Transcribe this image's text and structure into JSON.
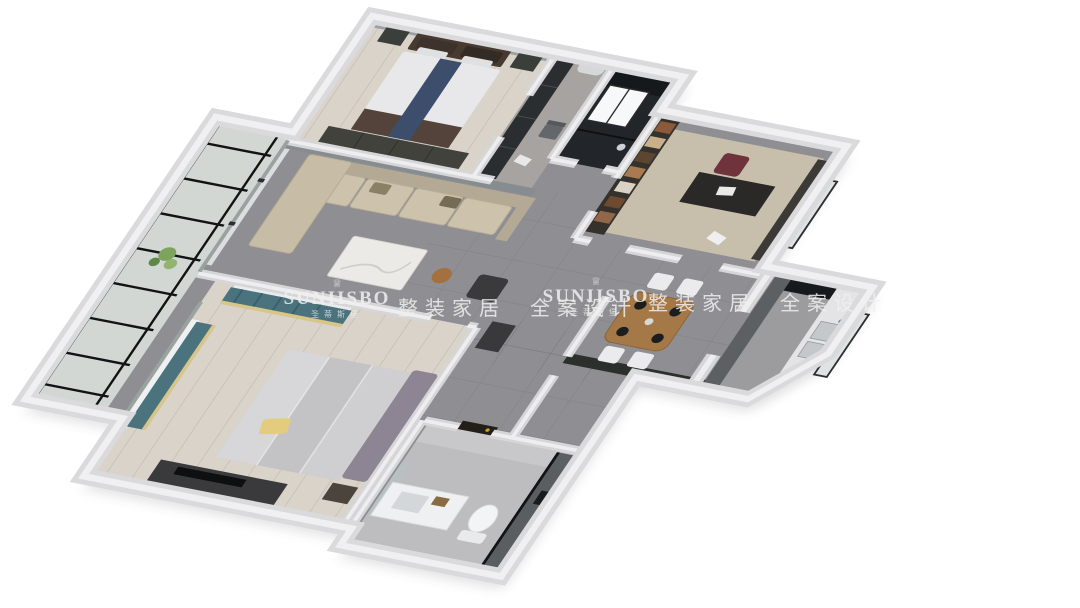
{
  "watermark": {
    "brand": "SUNIISBO",
    "brand_sub": "圣蒂斯堡",
    "slogan": "整装家居 全案设计",
    "crown_icon": "♕",
    "color": "#f0f0f0"
  },
  "scene": {
    "type": "3d-rendered-floor-plan",
    "view": "axonometric-top-down",
    "background": "#ffffff",
    "rooms": [
      {
        "id": "bedroom-top",
        "floor": "#d9d3c9",
        "features": [
          "double-bed",
          "dark-wardrobe",
          "gray-panel-headboard-wall",
          "blue-bed-runner"
        ]
      },
      {
        "id": "dressing-room",
        "floor": "#a6a3a0",
        "features": [
          "dark-wardrobe",
          "arched-mirror",
          "chair"
        ]
      },
      {
        "id": "bathroom-dark",
        "floor": "#22262a",
        "features": [
          "black-tile-walls",
          "white-window",
          "glass-partition"
        ]
      },
      {
        "id": "study",
        "floor": "#c8beac",
        "features": [
          "bookshelf",
          "desk",
          "maroon-chair",
          "window"
        ]
      },
      {
        "id": "living-room",
        "floor": "#8f8f93",
        "features": [
          "l-shaped-beige-sofa",
          "marble-coffee-table",
          "balcony-glass-doors"
        ]
      },
      {
        "id": "dining-room",
        "floor": "#8f8f93",
        "features": [
          "wood-table",
          "four-white-chairs",
          "black-plates",
          "dark-panel-wall"
        ]
      },
      {
        "id": "kitchen",
        "floor": "#9c9c9e",
        "features": [
          "white-counter",
          "double-sink",
          "black-range-hood",
          "window"
        ]
      },
      {
        "id": "master-bedroom",
        "floor": "#d9d3c9",
        "features": [
          "gray-bed",
          "mauve-headboard",
          "teal-curtains",
          "yellow-pillow",
          "tv-dresser"
        ]
      },
      {
        "id": "bathroom-main",
        "floor": "#bdbdbf",
        "features": [
          "vanity",
          "toilet",
          "dark-glass-shower"
        ]
      },
      {
        "id": "balcony",
        "floor": "#ccd2cf",
        "features": [
          "black-grid-glazing",
          "green-plant"
        ]
      }
    ],
    "colors": {
      "outer_wall": "#dadadc",
      "wall_top_highlight": "#f0f0f2",
      "marble_floor": "#8f8f93",
      "wood_floor": "#d9d3c9",
      "dark_tile": "#22262a",
      "sofa_beige": "#cdc3ad",
      "teal_curtain": "#4a737e",
      "accent_yellow": "#e3cc7d",
      "accent_blue": "#3c4e6b",
      "headboard_mauve": "#8d8593",
      "table_wood": "#a57947",
      "glass": "#ccd2cf"
    }
  }
}
